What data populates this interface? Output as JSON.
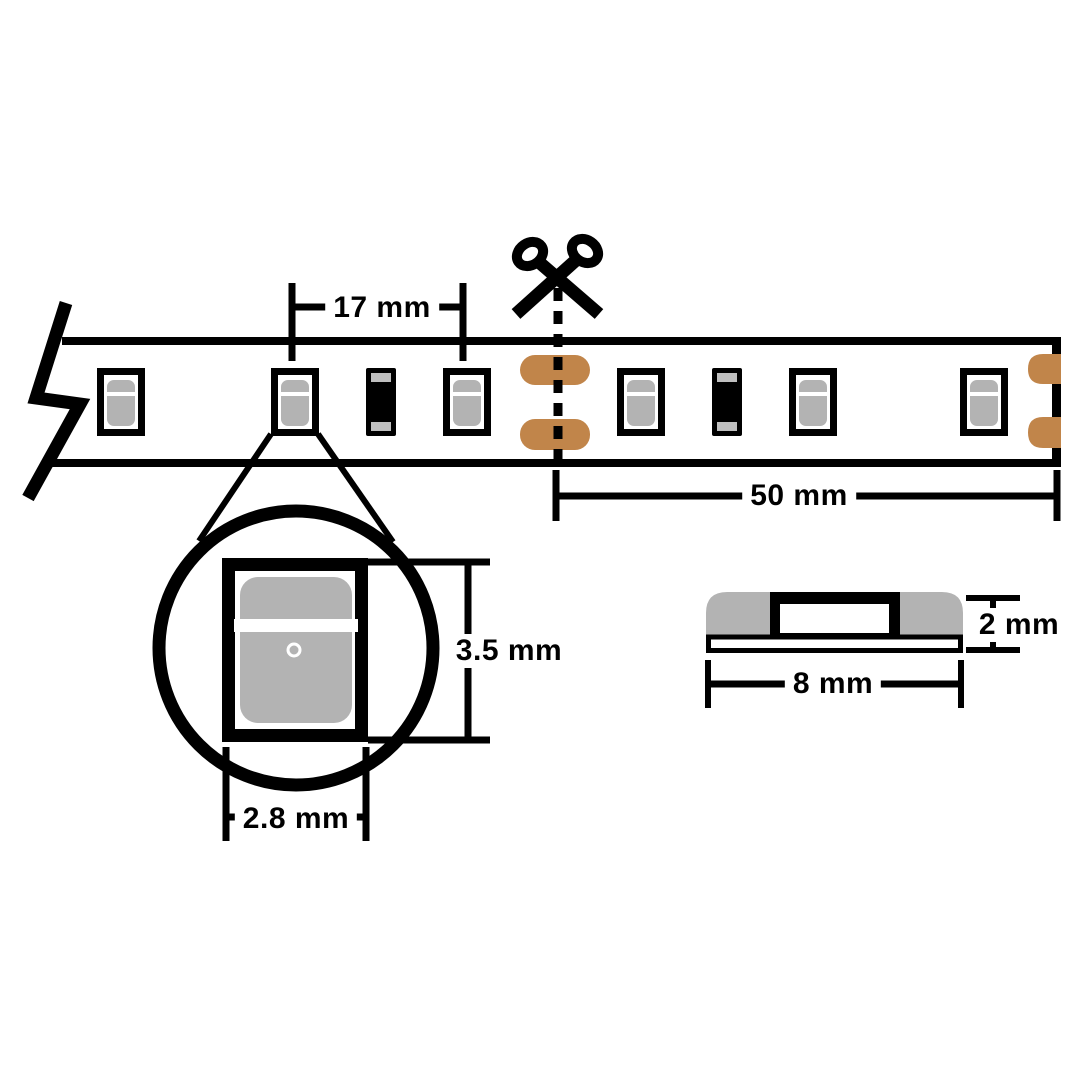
{
  "diagram": {
    "type": "technical-dimension-diagram",
    "subject": "LED strip light cut and dimension guide"
  },
  "dimensions": {
    "led_pitch": "17 mm",
    "cut_interval": "50 mm",
    "led_package_length": "3.5 mm",
    "led_package_width": "2.8 mm",
    "strip_thickness": "2 mm",
    "strip_width": "8 mm"
  },
  "strip": {
    "led_count": 6,
    "resistor_count": 2,
    "solder_pad_count": 4
  },
  "colors": {
    "line": "#000000",
    "component_gray": "#b3b3b3",
    "resistor_cap_gray": "#bfbfbf",
    "copper_pad": "#c1854a",
    "background": "#ffffff"
  }
}
